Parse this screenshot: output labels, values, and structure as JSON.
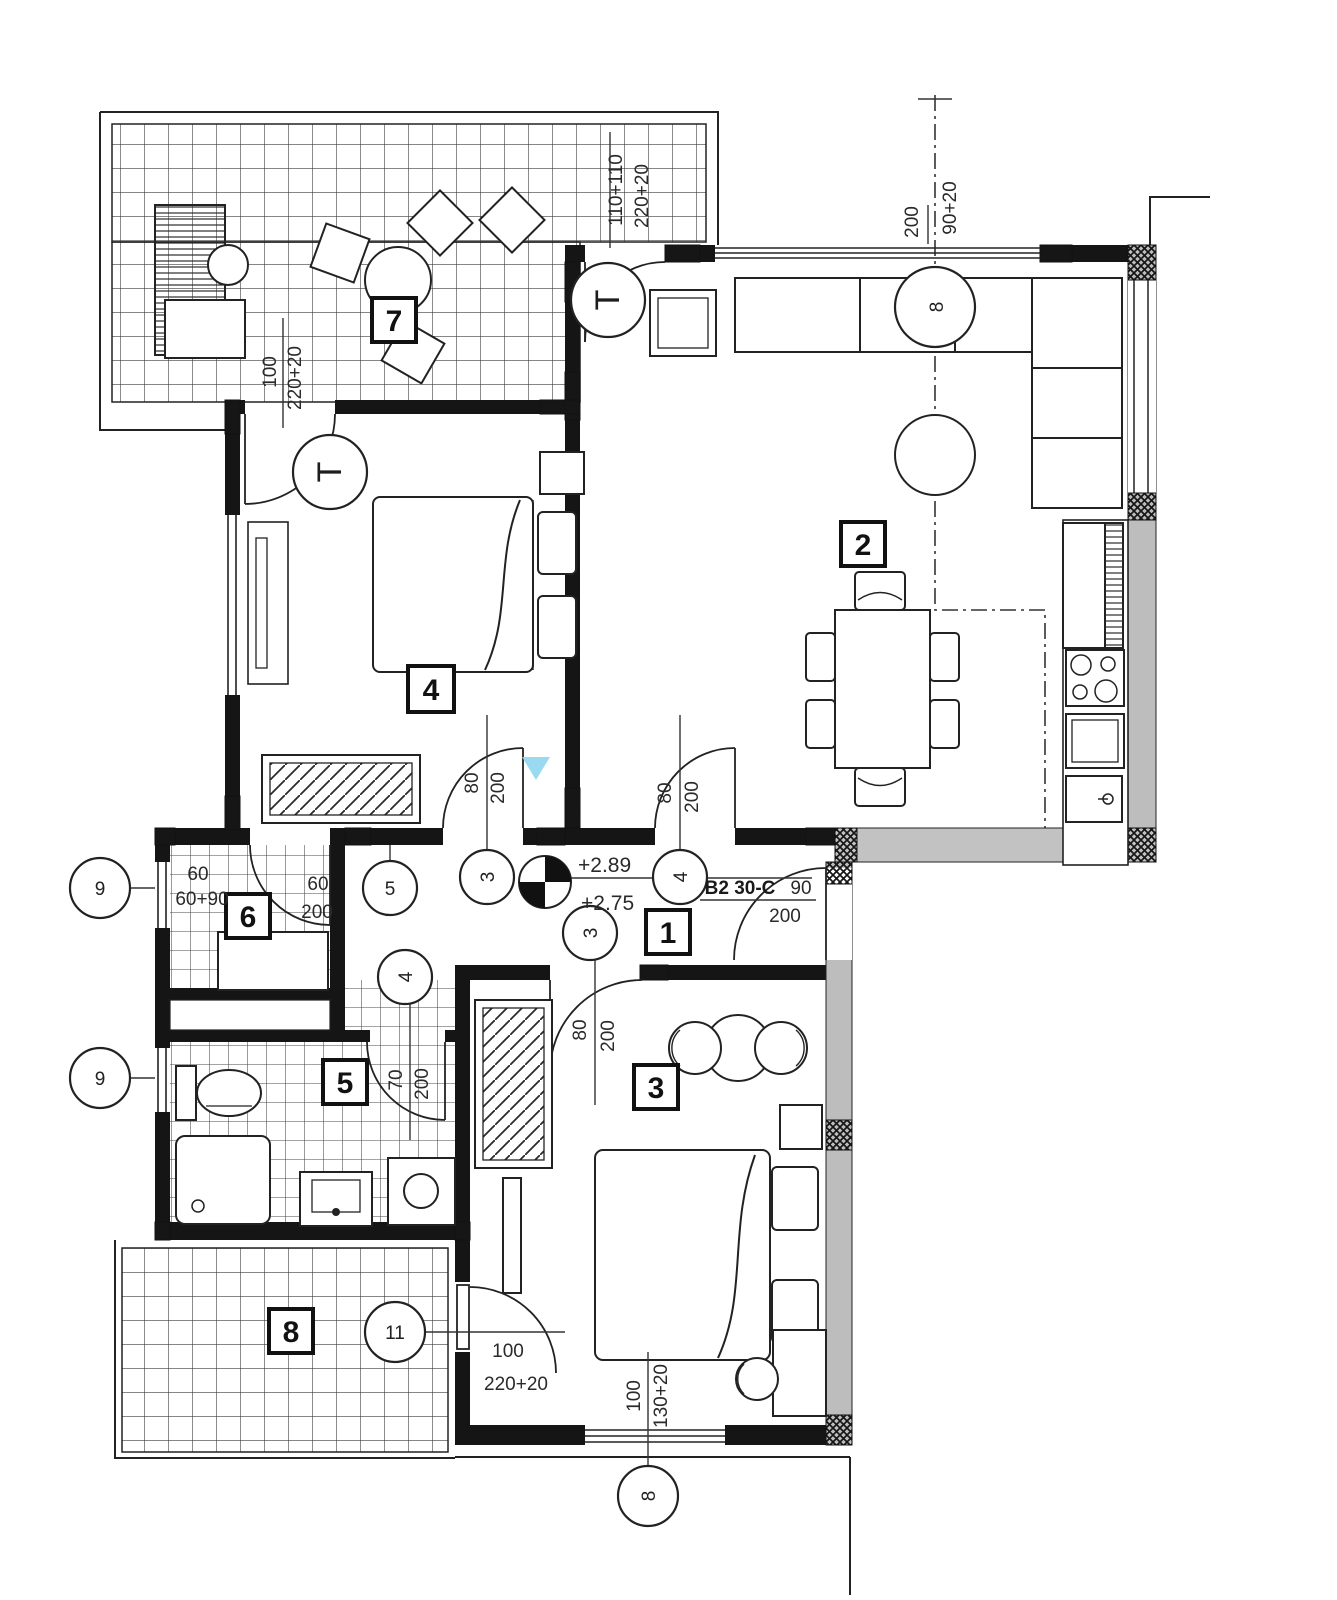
{
  "plan": {
    "title": "apartment-floor-plan B2 30-C",
    "rooms": {
      "r1": "1",
      "r2": "2",
      "r3": "3",
      "r4": "4",
      "r5": "5",
      "r6": "6",
      "r7": "7",
      "r8": "8"
    },
    "refs": {
      "c3": "3",
      "c4": "4",
      "c5": "5",
      "c8": "8",
      "c9": "9",
      "c11": "11",
      "radiator": "T"
    },
    "levels": {
      "upper": "+2.89",
      "lower": "+2.75"
    },
    "entry": {
      "unit": "B2 30-C",
      "door_w": "90",
      "door_h": "200"
    },
    "dims": {
      "terrace_open_a": "110+110",
      "terrace_open_b": "220+20",
      "bed4_terrace_door_w": "100",
      "bed4_terrace_door_h": "220+20",
      "living_win_w": "200",
      "living_win_h": "90+20",
      "hall_door1_w": "80",
      "hall_door1_h": "200",
      "hall_door2_w": "80",
      "hall_door2_h": "200",
      "bed3_door_w": "80",
      "bed3_door_h": "200",
      "bath_door_w": "70",
      "bath_door_h": "200",
      "wc6_win_w": "60",
      "wc6_win_h": "60+90",
      "wc6_door_w": "60",
      "wc6_door_h": "200",
      "bed3_win_w": "100",
      "bed3_win_h": "130+20",
      "terrace8_door_w": "100",
      "terrace8_door_h": "220+20"
    },
    "colors": {
      "wall": "#151515",
      "gray_wall": "#bdbdbd",
      "watermark": "#8ed6ee"
    }
  }
}
